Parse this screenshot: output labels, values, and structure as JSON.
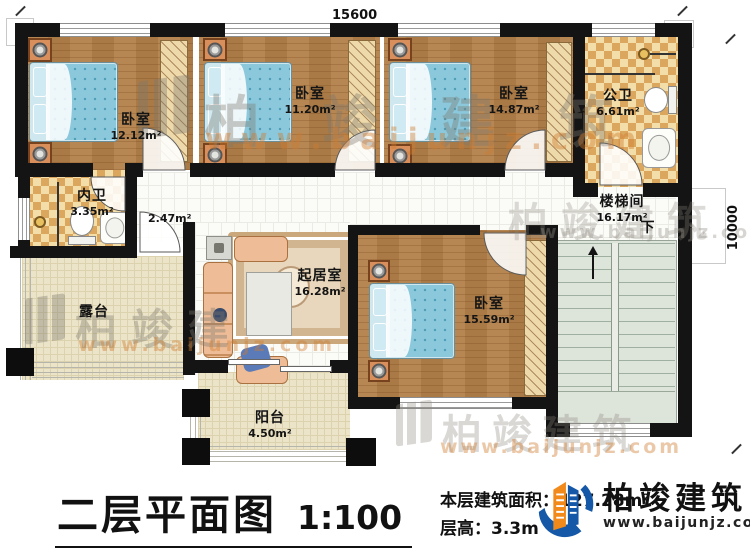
{
  "plan": {
    "dim_top": "15600",
    "dim_right": "10000",
    "rooms": {
      "bedroom1": {
        "name": "卧室",
        "area": "12.12m²"
      },
      "bedroom2": {
        "name": "卧室",
        "area": "11.20m²"
      },
      "bedroom3": {
        "name": "卧室",
        "area": "14.87m²"
      },
      "bedroom4": {
        "name": "卧室",
        "area": "15.59m²"
      },
      "public_bath": {
        "name": "公卫",
        "area": "6.61m²"
      },
      "inner_bath": {
        "name": "内卫",
        "area": "3.35m²"
      },
      "corridor": {
        "area": "2.47m²"
      },
      "stair_hall": {
        "name": "楼梯间",
        "area": "16.17m²"
      },
      "living": {
        "name": "起居室",
        "area": "16.28m²"
      },
      "terrace": {
        "name": "露台"
      },
      "balcony": {
        "name": "阳台",
        "area": "4.50m²"
      }
    },
    "stairs_down": "下"
  },
  "footer": {
    "title": "二层平面图",
    "scale": "1:100",
    "area_label": "本层建筑面积：",
    "area_value": "127.28m²",
    "floor_height_label": "层高：",
    "floor_height_value": "3.3m"
  },
  "brand": {
    "name": "柏竣建筑",
    "website": "www.baijunjz.com"
  },
  "watermark": {
    "name": "柏竣建筑",
    "name_short": "柏竣建",
    "website": "www.baijunjz.com"
  },
  "colors": {
    "wall": "#141414",
    "wood": "#b2804a",
    "tile": "#f3dda8",
    "accent_blue": "#1558a8",
    "accent_orange": "#f28a1b"
  }
}
